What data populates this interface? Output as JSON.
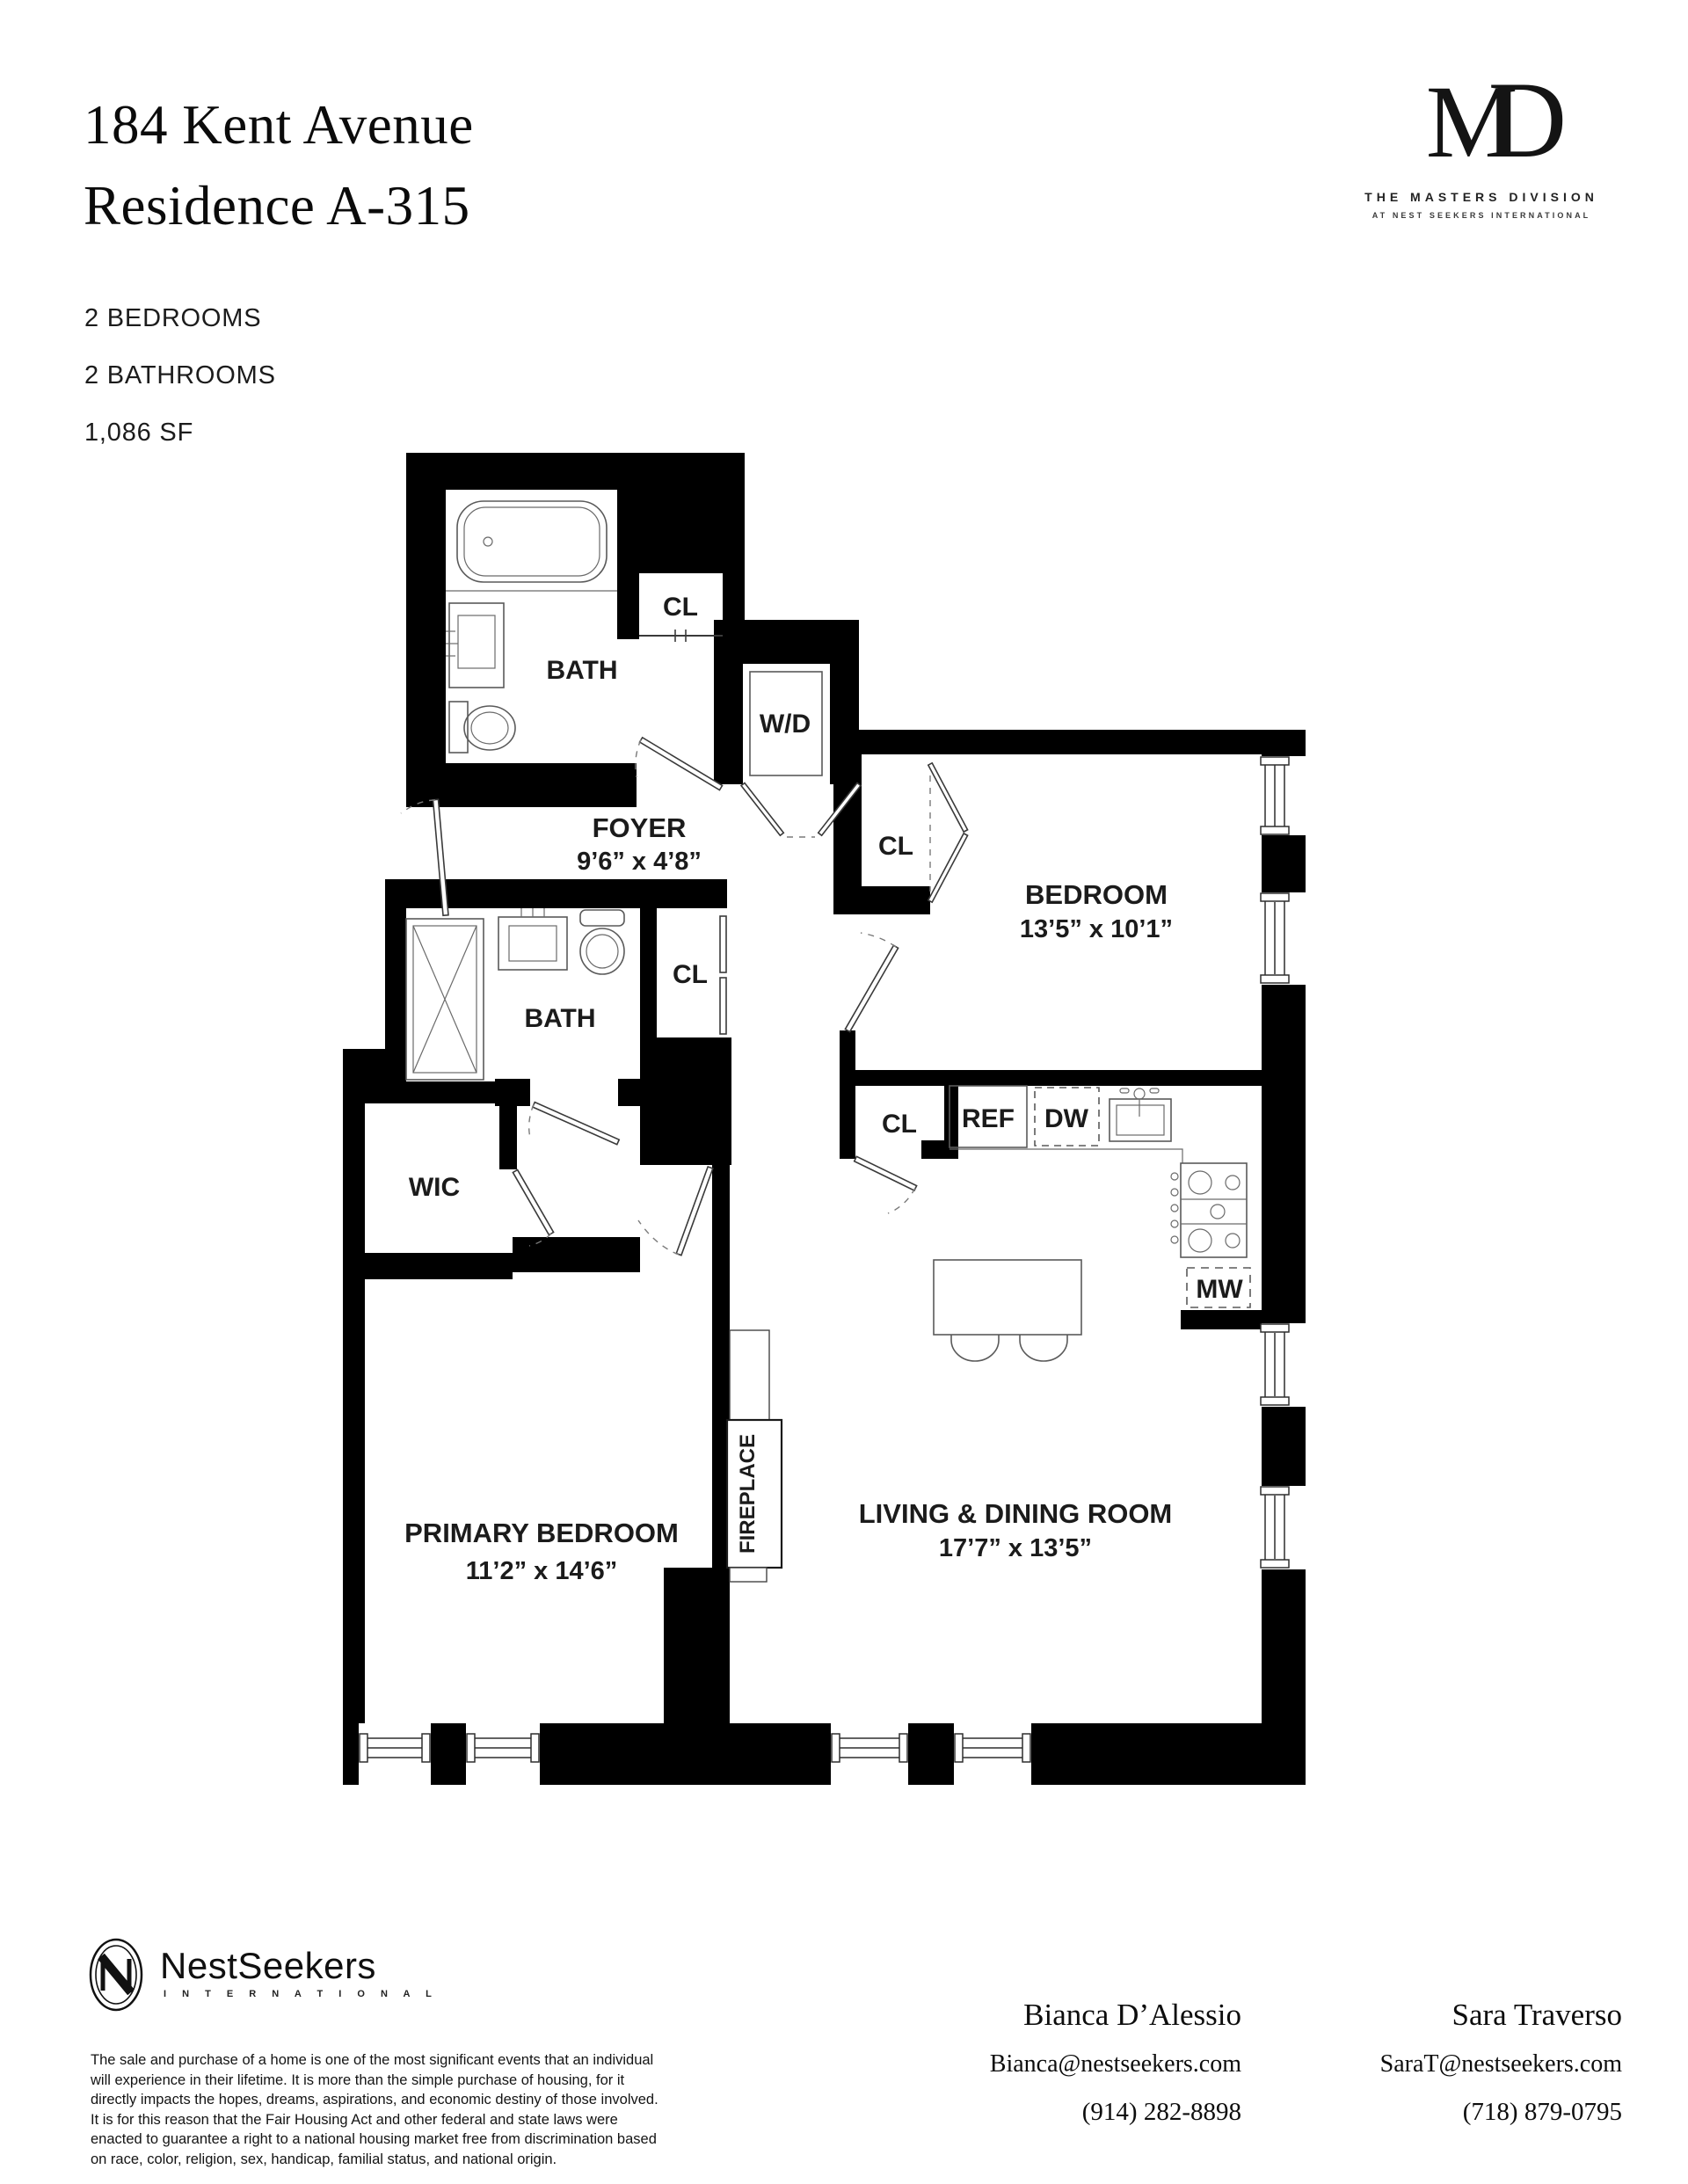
{
  "header": {
    "title_line1": "184 Kent Avenue",
    "title_line2": "Residence A-315",
    "specs": [
      "2 BEDROOMS",
      "2 BATHROOMS",
      "1,086 SF"
    ]
  },
  "brand": {
    "monogram_m": "M",
    "monogram_d": "D",
    "line1": "THE MASTERS DIVISION",
    "line2": "AT NEST SEEKERS INTERNATIONAL"
  },
  "floorplan": {
    "labels": {
      "bath_top": "BATH",
      "cl_top": "CL",
      "wd": "W/D",
      "foyer": "FOYER",
      "foyer_dims": "9’6” x 4’8”",
      "cl_bedroom": "CL",
      "bedroom": "BEDROOM",
      "bedroom_dims": "13’5” x 10’1”",
      "bath_second": "BATH",
      "cl_bath": "CL",
      "wic": "WIC",
      "cl_kitchen": "CL",
      "ref": "REF",
      "dw": "DW",
      "mw": "MW",
      "primary": "PRIMARY BEDROOM",
      "primary_dims": "11’2” x 14’6”",
      "fireplace": "FIREPLACE",
      "living": "LIVING & DINING ROOM",
      "living_dims": "17’7” x 13’5”"
    }
  },
  "footer": {
    "logo_word": "NestSeekers",
    "logo_sub": "I N T E R N A T I O N A L",
    "disclaimer": "The sale and purchase of a home is one of the most significant events that an individual will experience in their lifetime. It is more than the simple purchase of housing, for it directly impacts the hopes, dreams, aspirations, and economic destiny of those involved. It is for this reason that the Fair Housing Act and other federal and state laws were enacted to guarantee a right to a national housing market free from discrimination based on race, color, religion, sex, handicap, familial status, and national origin.",
    "contact1": {
      "name": "Bianca D’Alessio",
      "email": "Bianca@nestseekers.com",
      "phone": "(914) 282-8898"
    },
    "contact2": {
      "name": "Sara Traverso",
      "email": "SaraT@nestseekers.com",
      "phone": "(718) 879-0795"
    }
  }
}
